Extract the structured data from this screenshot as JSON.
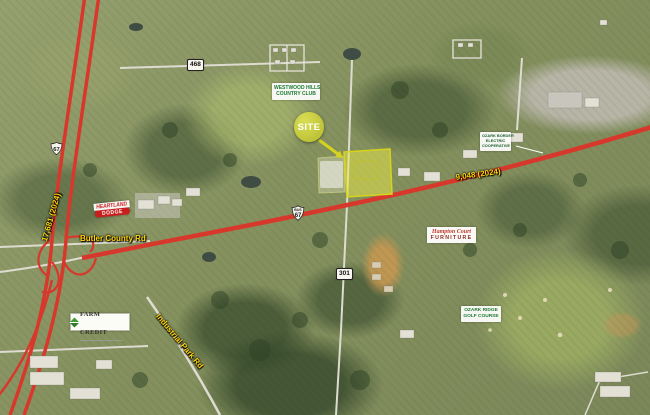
{
  "map": {
    "site": {
      "label": "SITE"
    },
    "places": {
      "country_club": [
        "WESTWOOD HILLS",
        "COUNTRY CLUB"
      ],
      "golf_course": [
        "OZARK RIDGE",
        "GOLF COURSE"
      ],
      "electric_coop": [
        "OZARK BORDER",
        "ELECTRIC",
        "COOPERATIVE"
      ]
    },
    "road_names": {
      "butler_county_rd": "Butler County Rd",
      "industrial_park_rd": "Industrial Park Rd"
    },
    "traffic_counts": {
      "us_67": "17,681 (2024)",
      "bus_67": "9,048 (2024)"
    },
    "route_shields": {
      "us_67": "67",
      "bus_67_banner": "BUS",
      "bus_67": "67",
      "route_468": "468",
      "route_301": "301"
    },
    "businesses": {
      "farm_credit": "FARM CREDIT",
      "auto_dealer": [
        "HEARTLAND",
        "DODGE"
      ],
      "furniture_store": [
        "Hampton Court",
        "FURNITURE"
      ]
    },
    "colors": {
      "highway_red": "#d8382c",
      "site_marker_green": "#bfc437",
      "parcel_highlight_yellow": "#e6e63f",
      "place_label_green": "#1e7a34",
      "road_label_yellow": "#ffd60a"
    }
  }
}
